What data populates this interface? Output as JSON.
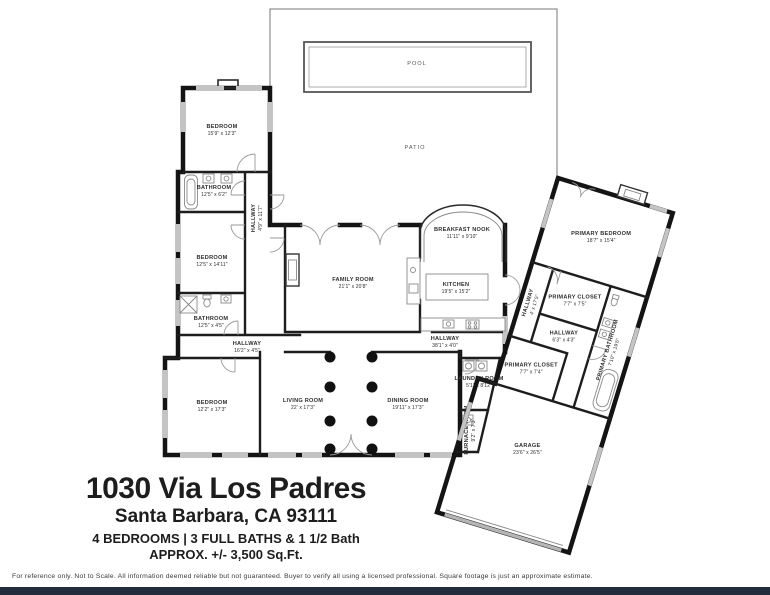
{
  "title_block": {
    "address": "1030 Via Los Padres",
    "city": "Santa Barbara, CA 93111",
    "beds_baths": "4 BEDROOMS | 3 FULL BATHS & 1 1/2 Bath",
    "sqft": "APPROX. +/- 3,500 Sq.Ft."
  },
  "disclaimer": "For reference only. Not to Scale.  All information deemed reliable but not guaranteed.  Buyer to verify all using a licensed professional. Square footage is just an approximate estimate.",
  "outdoor": {
    "pool_label": "POOL",
    "patio_label": "PATIO"
  },
  "rooms": {
    "bedroom1": {
      "name": "BEDROOM",
      "dims": "15'9\" x 12'3\""
    },
    "bathroom1": {
      "name": "BATHROOM",
      "dims": "12'5\" x 6'2\""
    },
    "hallway1": {
      "name": "HALLWAY",
      "dims": "4'9\" x 11'7\""
    },
    "bedroom2": {
      "name": "BEDROOM",
      "dims": "12'5\" x 14'11\""
    },
    "bathroom2": {
      "name": "BATHROOM",
      "dims": "12'5\" x 4'5\""
    },
    "hallway2": {
      "name": "HALLWAY",
      "dims": "16'2\" x 4'5\""
    },
    "bedroom3": {
      "name": "BEDROOM",
      "dims": "12'2\" x 17'3\""
    },
    "family": {
      "name": "FAMILY ROOM",
      "dims": "21'1\" x 20'8\""
    },
    "nook": {
      "name": "BREAKFAST NOOK",
      "dims": "11'11\" x 9'10\""
    },
    "kitchen": {
      "name": "KITCHEN",
      "dims": "19'5\" x 15'2\""
    },
    "hallway3": {
      "name": "HALLWAY",
      "dims": "38'1\" x 4'0\""
    },
    "living": {
      "name": "LIVING ROOM",
      "dims": "22' x 17'3\""
    },
    "dining": {
      "name": "DINING ROOM",
      "dims": "19'11\" x 17'3\""
    },
    "laundry": {
      "name": "LAUNDRY ROOM",
      "dims": "5'1\" x 8'12\""
    },
    "furnace": {
      "name": "FURNACE ROOM",
      "dims": "9'2\" x 7'3\""
    },
    "primary_bedroom": {
      "name": "PRIMARY BEDROOM",
      "dims": "18'7\" x 15'4\""
    },
    "primary_closet1": {
      "name": "PRIMARY CLOSET",
      "dims": "7'7\" x 7'5\""
    },
    "hallway4": {
      "name": "HALLWAY",
      "dims": "4' x 17'5\""
    },
    "hallway5": {
      "name": "HALLWAY",
      "dims": "6'3\" x 4'3\""
    },
    "primary_bath": {
      "name": "PRIMARY BATHROOM",
      "dims": "7'10\" x 19'6\""
    },
    "primary_closet2": {
      "name": "PRIMARY CLOSET",
      "dims": "7'7\" x 7'4\""
    },
    "garage": {
      "name": "GARAGE",
      "dims": "23'6\" x 26'5\""
    }
  },
  "colors": {
    "wall": "#141414",
    "window": "#c4c4c4",
    "door_arc": "#9a9a9a",
    "bottom_bar": "#232c3d",
    "text": "#2e2e2e"
  }
}
